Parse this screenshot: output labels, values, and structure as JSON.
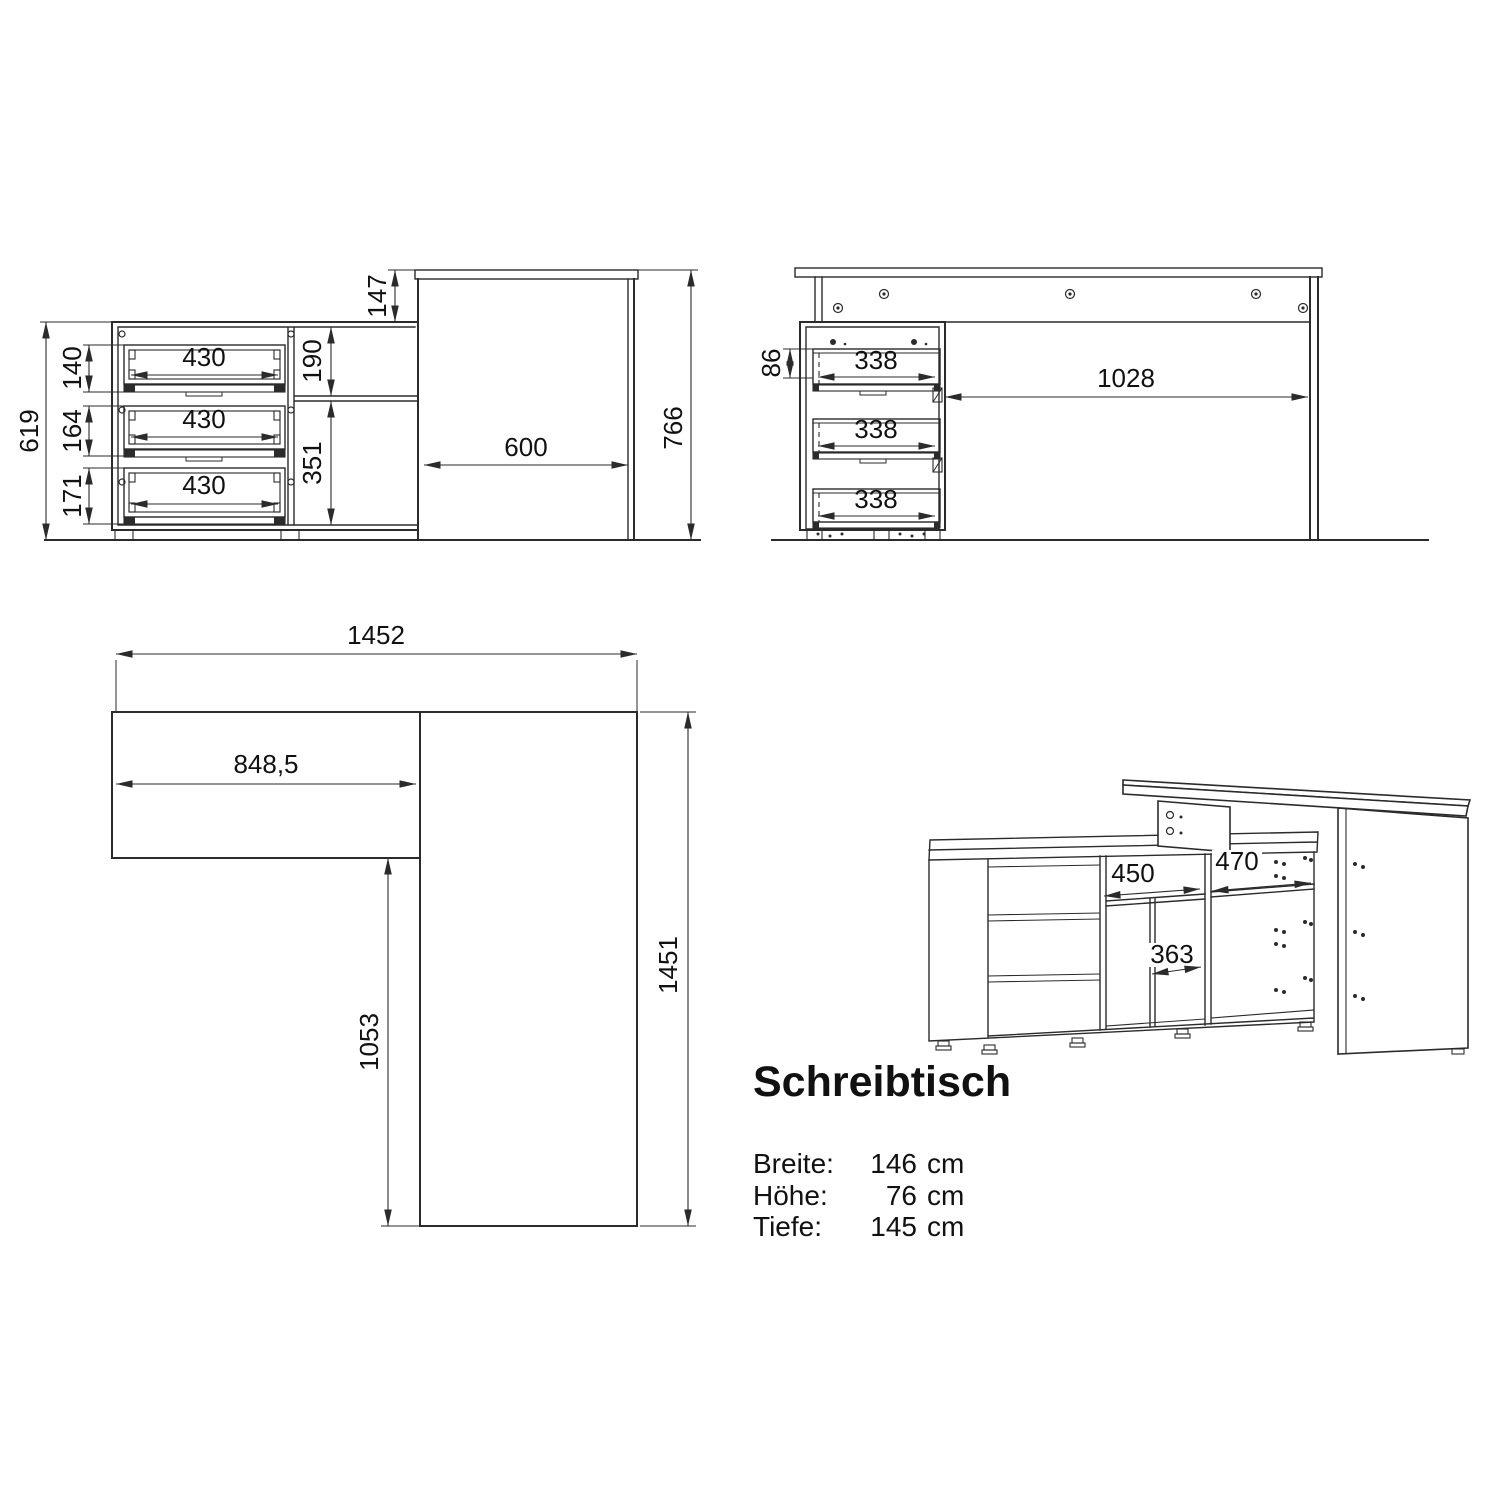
{
  "title": "Schreibtisch",
  "specs": {
    "rows": [
      {
        "label": "Breite:",
        "value": "146",
        "unit": "cm"
      },
      {
        "label": "Höhe:",
        "value": "76",
        "unit": "cm"
      },
      {
        "label": "Tiefe:",
        "value": "145",
        "unit": "cm"
      }
    ]
  },
  "views": {
    "front": {
      "left_height": "619",
      "drawer_heights": [
        "140",
        "164",
        "171"
      ],
      "drawer_width": "430",
      "top_offset": "147",
      "upper_compartment": "190",
      "lower_compartment": "351",
      "desk_depth": "600",
      "total_height": "766"
    },
    "back": {
      "drawer_back_height": "86",
      "drawer_width": "338",
      "knee_space": "1028"
    },
    "plan": {
      "total_width": "1452",
      "sideboard_width": "848,5",
      "desk_length": "1053",
      "total_depth": "1451"
    },
    "iso": {
      "left_compartment": "450",
      "right_compartment": "470",
      "middle_compartment": "363"
    }
  }
}
